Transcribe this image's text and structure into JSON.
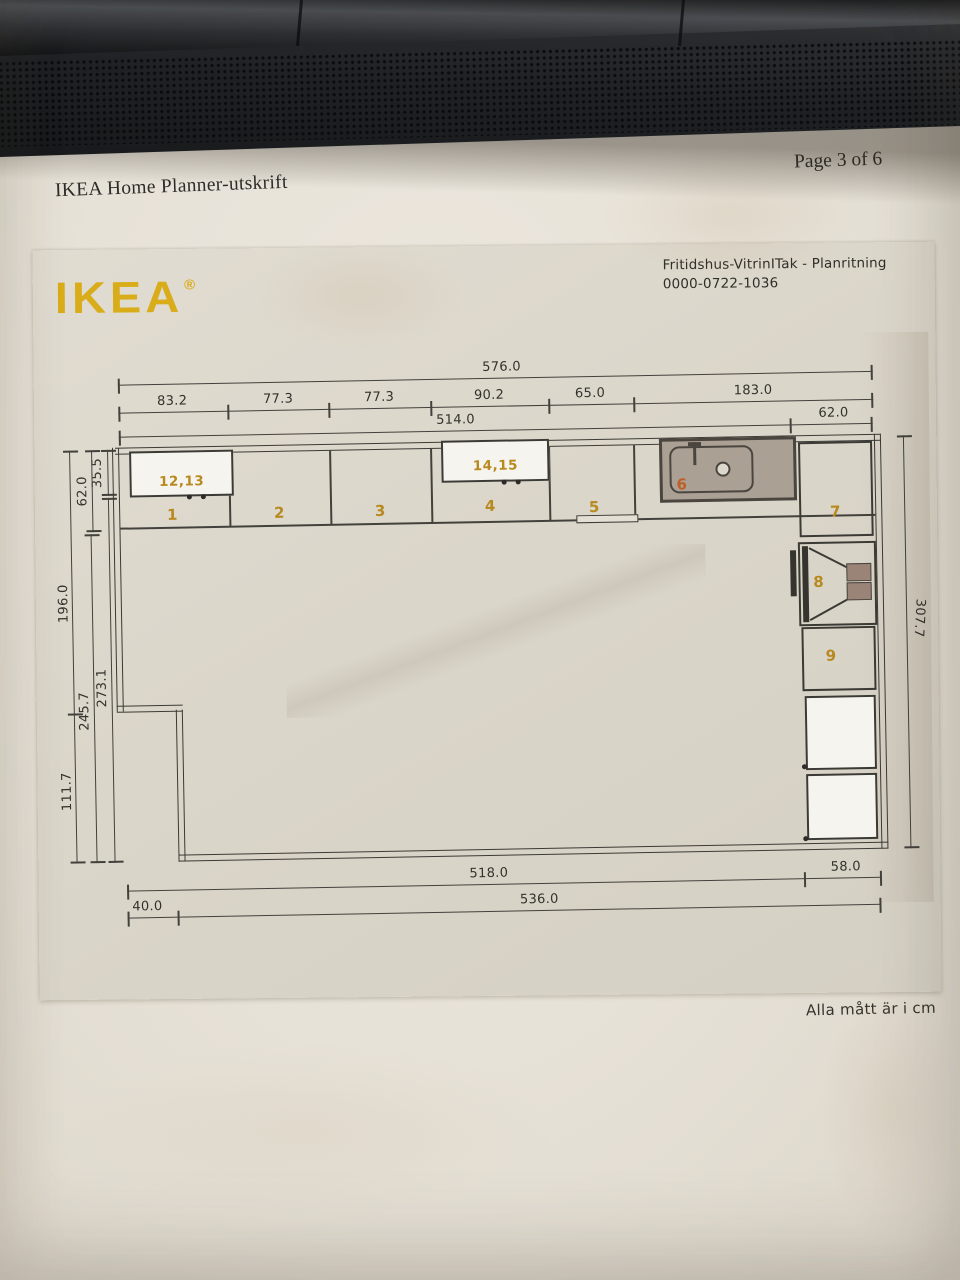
{
  "page": {
    "header_title": "IKEA Home Planner-utskrift",
    "page_number": "Page 3 of 6",
    "footer_note": "Alla mått är i cm"
  },
  "scan": {
    "logo": "IKEA",
    "registered_mark": "®",
    "doc_title": "Fritidshus-VitrinITak - Planritning",
    "doc_number": "0000-0722-1036"
  },
  "plan": {
    "unit_labels": [
      "1",
      "2",
      "3",
      "4",
      "5",
      "6",
      "7",
      "8",
      "9"
    ],
    "wall_cabinet_labels": [
      "12,13",
      "14,15"
    ],
    "dims": {
      "top_total": "576.0",
      "top_segments": [
        "83.2",
        "77.3",
        "77.3",
        "90.2",
        "65.0",
        "183.0"
      ],
      "inner_width": "514.0",
      "top_right": "62.0",
      "left_wallcab_depth": "35.5",
      "left_basecab_depth": "62.0",
      "left_upper": "196.0",
      "left_lower": "111.7",
      "left_clear_base": "245.7",
      "left_clear_wall": "273.1",
      "right_total": "307.7",
      "bottom_main": "518.0",
      "bottom_right": "58.0",
      "bottom_left": "40.0",
      "bottom_inner": "536.0"
    },
    "colors": {
      "ikea_yellow": "#d9ac1a",
      "label_orange": "#b8891f",
      "sink_fill": "#aba094",
      "line": "#42413c",
      "paper": "#e7e2d8",
      "scan_paper": "#dbd6ca"
    }
  }
}
